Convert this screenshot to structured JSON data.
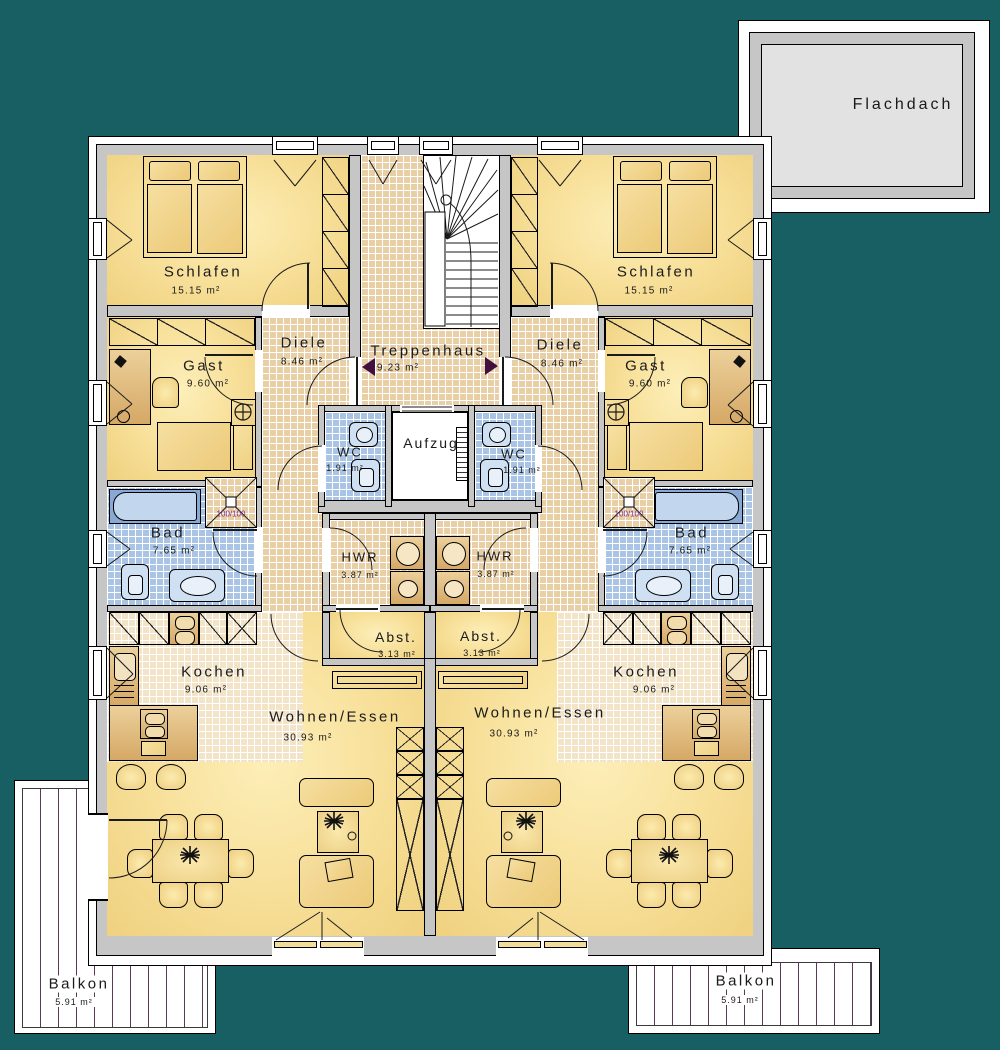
{
  "palette": {
    "background": "#175f62",
    "wall_gray": "#c6c6c6",
    "room_yellow": "#f6dd93",
    "tile_tan": "#e9cfa6",
    "tile_kitchen": "#f3e4c8",
    "tile_blue": "#a9c4e4",
    "wood": "#dfb577",
    "balcony_stripe": "#5d3757",
    "shower_text_purple": "#7d2f8f",
    "walkline_arrow_purple": "#42103f"
  },
  "labels": {
    "flachdach": "Flachdach",
    "schlafen": {
      "name": "Schlafen",
      "area": "15.15 m²"
    },
    "diele": {
      "name": "Diele",
      "area": "8.46 m²"
    },
    "treppenhaus": {
      "name": "Treppenhaus",
      "area": "9.23 m²"
    },
    "gast": {
      "name": "Gast",
      "area": "9.60 m²"
    },
    "wc": {
      "name": "WC",
      "area": "1.91 m²"
    },
    "aufzug": {
      "name": "Aufzug"
    },
    "bad": {
      "name": "Bad",
      "area": "7.65 m²"
    },
    "hwr": {
      "name": "HWR",
      "area": "3.87 m²"
    },
    "abst": {
      "name": "Abst.",
      "area": "3.13 m²"
    },
    "kochen": {
      "name": "Kochen",
      "area": "9.06 m²"
    },
    "wohnen": {
      "name": "Wohnen/Essen",
      "area": "30.93 m²"
    },
    "balkon": {
      "name": "Balkon",
      "area": "5.91 m²"
    },
    "shower_size": "100/100"
  }
}
